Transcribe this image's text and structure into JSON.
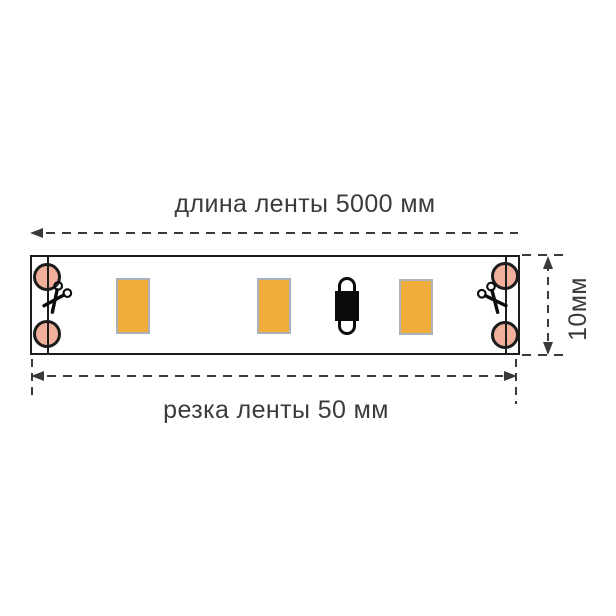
{
  "diagram": {
    "title_top": "длина ленты 5000 мм",
    "label_bottom": "резка ленты 50 мм",
    "label_side": "10мм",
    "icons": {
      "cut_marker": "scissors"
    },
    "strip": {
      "led_count": 3,
      "solder_pad_count": 4,
      "cut_line_count": 2,
      "component_count": 1
    },
    "colors": {
      "pad": "#f1b09b",
      "led_fill": "#f0ad3b",
      "led_border": "#a9b2bb",
      "line": "#3a3a3a",
      "strip_border": "#1c1c1c",
      "component": "#0b0b0b",
      "text": "#3b3b3b"
    }
  }
}
